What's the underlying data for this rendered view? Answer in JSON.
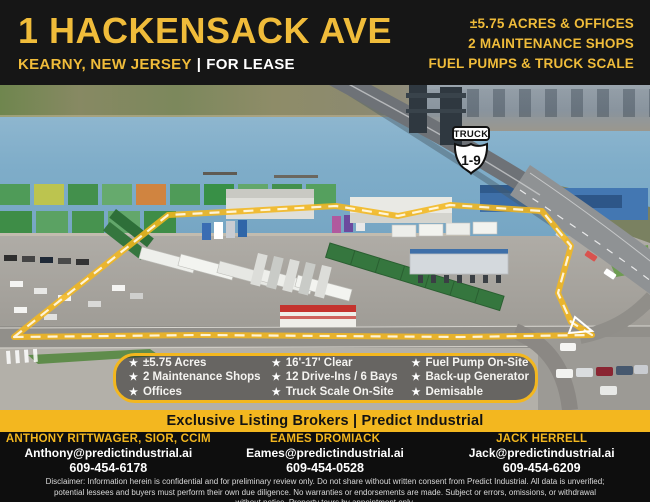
{
  "colors": {
    "brand_yellow": "#F3B71F",
    "header_yellow_text": "#F0BC3A",
    "header_bg": "#161616",
    "water_blue": "#7FADC9"
  },
  "header": {
    "title": "1 HACKENSACK AVE",
    "location": "KEARNY, NEW JERSEY",
    "divider": "|",
    "status": "FOR LEASE",
    "highlights": [
      "±5.75 ACRES & OFFICES",
      "2 MAINTENANCE SHOPS",
      "FUEL PUMPS & TRUCK SCALE"
    ]
  },
  "photo": {
    "sign": {
      "top": "TRUCK",
      "route": "1-9"
    }
  },
  "features": {
    "star": "★",
    "col1": [
      "±5.75 Acres",
      "2 Maintenance Shops",
      "Offices"
    ],
    "col2": [
      "16'-17' Clear",
      "12 Drive-Ins / 6 Bays",
      "Truck Scale On-Site"
    ],
    "col3": [
      "Fuel Pump On-Site",
      "Back-up Generator",
      "Demisable"
    ]
  },
  "band": {
    "label": "Exclusive Listing Brokers | Predict Industrial"
  },
  "brokers": [
    {
      "name": "ANTHONY RITTWAGER, SIOR, CCIM",
      "email": "Anthony@predictindustrial.ai",
      "phone": "609-454-6178"
    },
    {
      "name": "EAMES DROMIACK",
      "email": "Eames@predictindustrial.ai",
      "phone": "609-454-0528"
    },
    {
      "name": "JACK HERRELL",
      "email": "Jack@predictindustrial.ai",
      "phone": "609-454-6209"
    }
  ],
  "disclaimer": "Disclaimer: Information herein is confidential and for preliminary review only. Do not share without written consent from Predict Industrial. All data is unverified; potential lessees and buyers must perform their own due diligence. No warranties or endorsements are made. Subject or errors, omissions, or withdrawal without notice. Property tours by appointment only."
}
